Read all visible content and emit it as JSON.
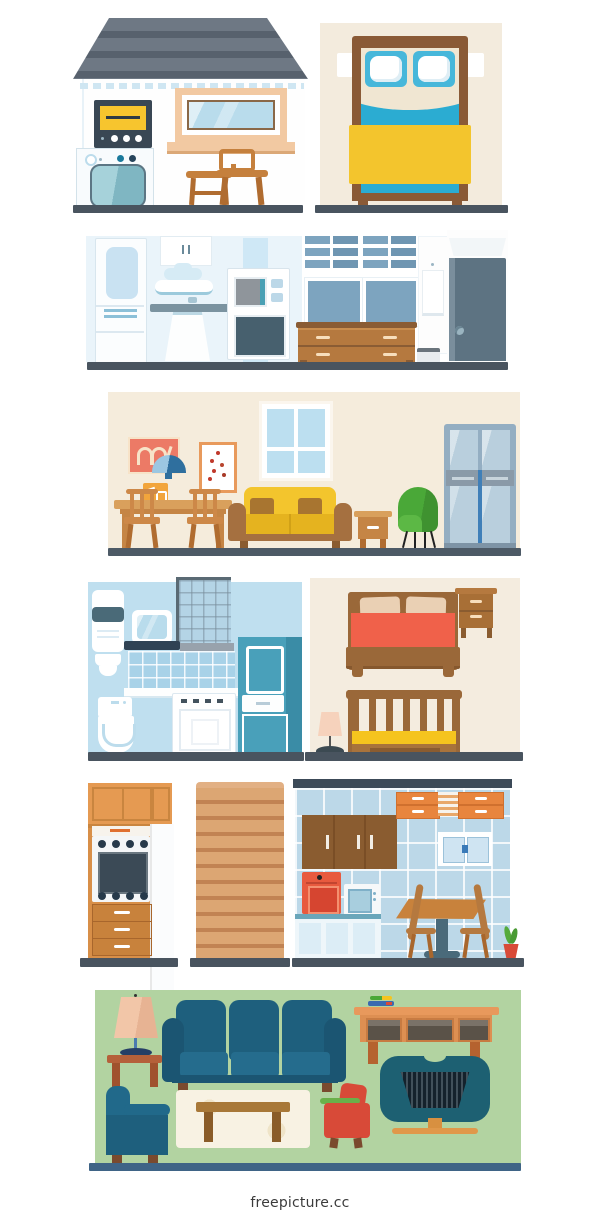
{
  "meta": {
    "watermark": "freepicture.cc",
    "canvas": {
      "width": 600,
      "height": 1220,
      "background": "#ffffff"
    },
    "description": "Flat vector illustration set of house room interiors in six horizontal panels"
  },
  "palette": {
    "floor_dark": "#49545f",
    "floor_blue": "#3f6486",
    "roof_gray": "#6e7884",
    "beige_wall": "#f3ebdd",
    "bath_blue": "#bfdfef",
    "tile_blue": "#b7d7e9",
    "teal_cabinet": "#49a0ba",
    "sheet_cyan": "#2bacd2",
    "pillow_blue": "#47b7da",
    "blanket_yellow": "#f3c52d",
    "wood_mid": "#b5793f",
    "wood_light": "#cd8848",
    "wood_orange": "#e59a52",
    "stairs_wood": "#d99e6c",
    "cabinet_brown": "#8a5c30",
    "cabinet_orange": "#e8853e",
    "coral_blanket": "#f0614a",
    "red_accent": "#d84a38",
    "green_chair": "#4aa838",
    "green_room": "#b2d3a1",
    "pane_slate": "#7da4bf",
    "door_slate": "#5d7382",
    "sofa_teal": "#1e5f7d",
    "tv_teal": "#1d6072",
    "lamp_peach": "#f2c6a8"
  },
  "sections": [
    {
      "id": "house-exterior",
      "label": "House exterior with roof, washing machine, window and two stools"
    },
    {
      "id": "bedroom-top-view",
      "label": "Bedroom, double bed seen from above with two pillows and yellow blanket"
    },
    {
      "id": "kitchen-hallway",
      "label": "Kitchen and hallway with fridge, sink, microwave, oven, dresser and door"
    },
    {
      "id": "living-dining-room",
      "label": "Living room with dining table, yellow sofa, green wing chair and wardrobe"
    },
    {
      "id": "bathroom",
      "label": "Blue bathroom with water heater, shower glass, toilet, dishwasher and teal cabinet"
    },
    {
      "id": "bedroom-front-view",
      "label": "Bedroom with coral bed, nightstand, crib and floor lamp"
    },
    {
      "id": "kitchen-units",
      "label": "Oven cabinet unit, wooden staircase and tiled kitchen with table and chairs"
    },
    {
      "id": "green-living-room",
      "label": "Green living room with teal sofa, armchairs, coffee table, TV console and TV"
    }
  ]
}
